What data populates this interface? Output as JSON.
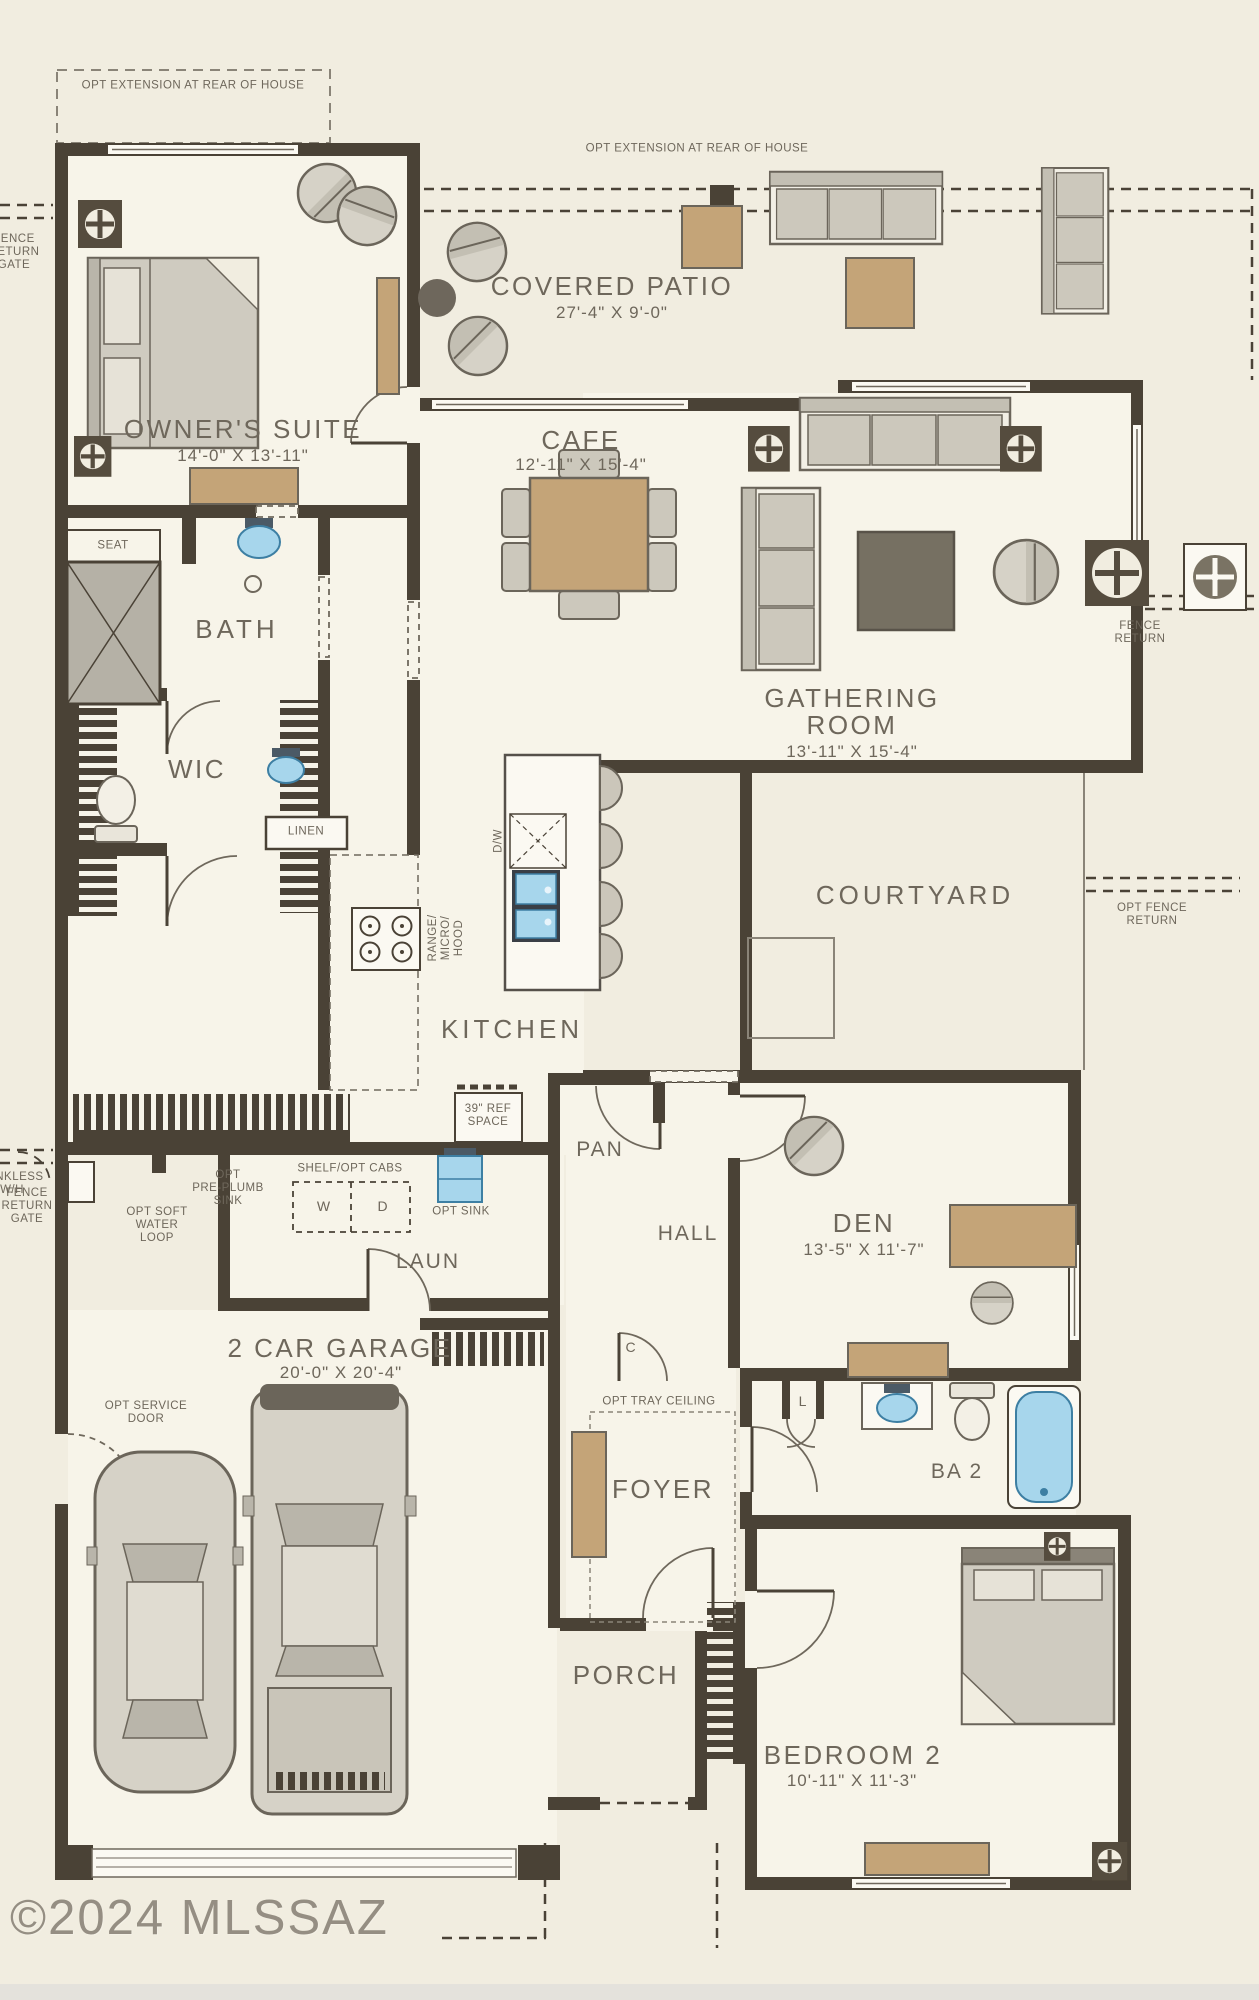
{
  "watermark": "©2024 MLSSAZ",
  "colors": {
    "background": "#f1ede0",
    "interior": "#f7f4e9",
    "wall": "#4a4236",
    "furniture_gray": "#cfcbc0",
    "accent_tan": "#c4a478",
    "fixture_blue": "#a7d6ec",
    "text": "#6e675b"
  },
  "rooms": {
    "owners_suite": {
      "name": "OWNER'S SUITE",
      "dims": "14'-0\" X 13'-11\""
    },
    "covered_patio": {
      "name": "COVERED PATIO",
      "dims": "27'-4\" X 9'-0\""
    },
    "cafe": {
      "name": "CAFE",
      "dims": "12'-11\" X 15'-4\""
    },
    "gathering_room": {
      "name_line1": "GATHERING",
      "name_line2": "ROOM",
      "dims": "13'-11\" X 15'-4\""
    },
    "kitchen": {
      "name": "KITCHEN"
    },
    "bath": {
      "name": "BATH"
    },
    "wic": {
      "name": "WIC"
    },
    "courtyard": {
      "name": "COURTYARD"
    },
    "den": {
      "name": "DEN",
      "dims": "13'-5\" X 11'-7\""
    },
    "hall": {
      "name": "HALL"
    },
    "laundry": {
      "name": "LAUN"
    },
    "pantry": {
      "name": "PAN"
    },
    "garage": {
      "name": "2 CAR GARAGE",
      "dims": "20'-0\" X 20'-4\""
    },
    "foyer": {
      "name": "FOYER"
    },
    "bath2": {
      "name": "BA 2"
    },
    "porch": {
      "name": "PORCH"
    },
    "bedroom2": {
      "name": "BEDROOM 2",
      "dims": "10'-11\" X 11'-3\""
    }
  },
  "annotations": {
    "opt_extension_left": "OPT EXTENSION AT REAR OF HOUSE",
    "opt_extension_right": "OPT EXTENSION AT REAR OF HOUSE",
    "fence_return_gate_upper": "FENCE\nRETURN\nGATE",
    "fence_return_gate_lower": "FENCE\nRETURN\nGATE",
    "fence_return_right": "FENCE\nRETURN",
    "opt_fence_return": "OPT FENCE\nRETURN",
    "tankless_wh": "TANKLESS\nW/H",
    "seat": "SEAT",
    "linen": "LINEN",
    "range_micro_hood": "RANGE/\nMICRO/\nHOOD",
    "dw": "D/W",
    "ref_space": "39\" REF\nSPACE",
    "opt_pre_plumb_sink": "OPT\nPRE-PLUMB\nSINK",
    "opt_soft_water_loop": "OPT SOFT\nWATER\nLOOP",
    "shelf_opt_cabs": "SHELF/OPT CABS",
    "washer": "W",
    "dryer": "D",
    "opt_sink": "OPT SINK",
    "opt_service_door": "OPT SERVICE\nDOOR",
    "opt_tray_ceiling": "OPT TRAY CEILING",
    "coat_closet": "C",
    "linen2": "L"
  }
}
